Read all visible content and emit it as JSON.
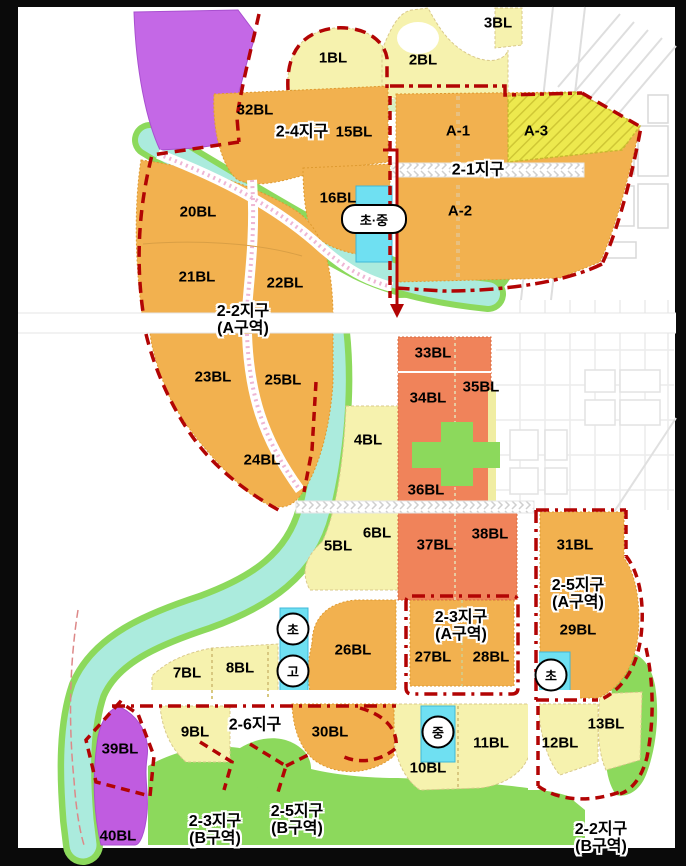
{
  "map": {
    "kind": "urban-district-land-use-plan",
    "blocks": {
      "bl1": "1BL",
      "bl2": "2BL",
      "bl3": "3BL",
      "bl4": "4BL",
      "bl5": "5BL",
      "bl6": "6BL",
      "bl7": "7BL",
      "bl8": "8BL",
      "bl9": "9BL",
      "bl10": "10BL",
      "bl11": "11BL",
      "bl12": "12BL",
      "bl13": "13BL",
      "bl15": "15BL",
      "bl16": "16BL",
      "bl20": "20BL",
      "bl21": "21BL",
      "bl22": "22BL",
      "bl23": "23BL",
      "bl24": "24BL",
      "bl25": "25BL",
      "bl26": "26BL",
      "bl27": "27BL",
      "bl28": "28BL",
      "bl29": "29BL",
      "bl30": "30BL",
      "bl31": "31BL",
      "bl32": "32BL",
      "bl33": "33BL",
      "bl34": "34BL",
      "bl35": "35BL",
      "bl36": "36BL",
      "bl37": "37BL",
      "bl38": "38BL",
      "bl39": "39BL",
      "bl40": "40BL",
      "a1": "A-1",
      "a2": "A-2",
      "a3": "A-3"
    },
    "districts": {
      "d24": "2-4지구",
      "d21": "2-1지구",
      "d22a_1": "2-2지구",
      "d22a_2": "(A구역)",
      "d25a_1": "2-5지구",
      "d25a_2": "(A구역)",
      "d23a_1": "2-3지구",
      "d23a_2": "(A구역)",
      "d26": "2-6지구",
      "d23b_1": "2-3지구",
      "d23b_2": "(B구역)",
      "d25b_1": "2-5지구",
      "d25b_2": "(B구역)",
      "d22b_1": "2-2지구",
      "d22b_2": "(B구역)"
    },
    "school_badges": {
      "elementary_middle": "초·중",
      "elementary": "초",
      "high": "고",
      "middle": "중"
    },
    "colors": {
      "residential_orange": "#F2B14F",
      "commercial_coral": "#F0835A",
      "lowrise_cream": "#F6F2AE",
      "hatched_yellow": "#EDE94E",
      "park_green": "#8CD95C",
      "river_cyan": "#ABEBDD",
      "school_cyan": "#6FE0F2",
      "special_purple": "#C468E6",
      "special_magenta": "#C05CE0",
      "boundary_red": "#B20404"
    }
  }
}
